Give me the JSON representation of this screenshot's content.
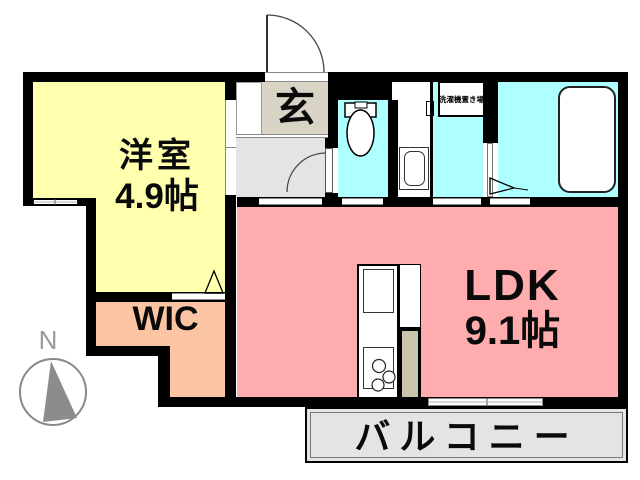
{
  "floorplan": {
    "rooms": {
      "western": {
        "name": "洋室",
        "size": "4.9帖",
        "color": "#FFFFAE"
      },
      "ldk": {
        "name": "LDK",
        "size": "9.1帖",
        "color": "#FFACAE"
      },
      "wic": {
        "name": "WIC",
        "color": "#FBC5A4"
      },
      "entrance": {
        "name": "玄",
        "color": "#D9D4C5"
      },
      "balcony": {
        "name": "バルコニー",
        "color": "#E4E4E4"
      },
      "laundry": {
        "name": "洗濯機置き場"
      },
      "wet_area_color": "#AEFFFF",
      "hall_color": "#E4E4E4"
    },
    "compass": {
      "north_label": "N",
      "needle_color": "#8C8C8C"
    },
    "wall_color": "#000000"
  }
}
